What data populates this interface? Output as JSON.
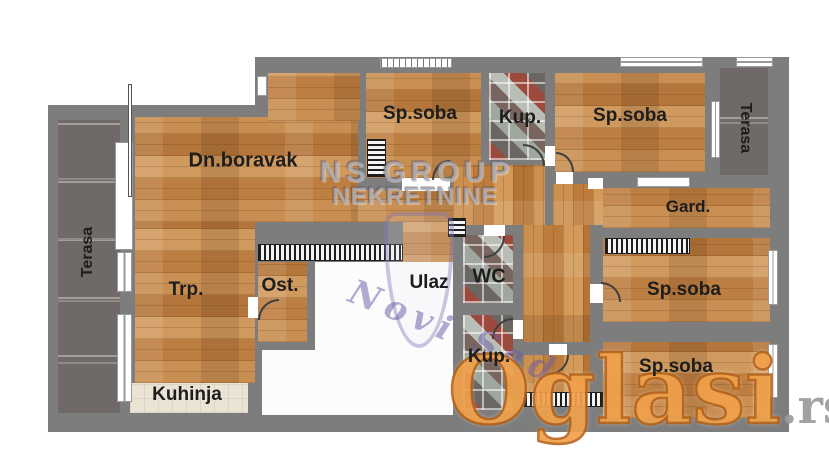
{
  "plan": {
    "rooms": {
      "living": {
        "label": "Dn.boravak"
      },
      "bedroom_top_left": {
        "label": "Sp.soba"
      },
      "bath_top": {
        "label": "Kup."
      },
      "bedroom_top_right": {
        "label": "Sp.soba"
      },
      "terrace_right": {
        "label": "Terasa"
      },
      "wardrobe": {
        "label": "Gard."
      },
      "bedroom_mid_right": {
        "label": "Sp.soba"
      },
      "bedroom_bottom_right": {
        "label": "Sp.soba"
      },
      "wc": {
        "label": "WC"
      },
      "bath_bottom": {
        "label": "Kup."
      },
      "entry": {
        "label": "Ulaz"
      },
      "pantry": {
        "label": "Ost."
      },
      "dining": {
        "label": "Trp."
      },
      "kitchen": {
        "label": "Kuhinja"
      },
      "terrace_left": {
        "label": "Terasa"
      }
    },
    "watermarks": {
      "agency_line1": "NS GROUP",
      "agency_line2": "NEKRETNINE",
      "agency_city": "Novi Sad",
      "portal_name": "Oglasi",
      "portal_tld": ".rs"
    },
    "colors": {
      "wall": "#7d7d7d",
      "wood": "#c98f52",
      "terrace": "#6f6a68",
      "tile_red": "#9d4a3e",
      "kitchen_floor": "#ebe4d4",
      "hall_floor": "#fcfcfc",
      "portal_orange": "#f0a14b",
      "watermark_purple": "#6c60aa"
    }
  }
}
